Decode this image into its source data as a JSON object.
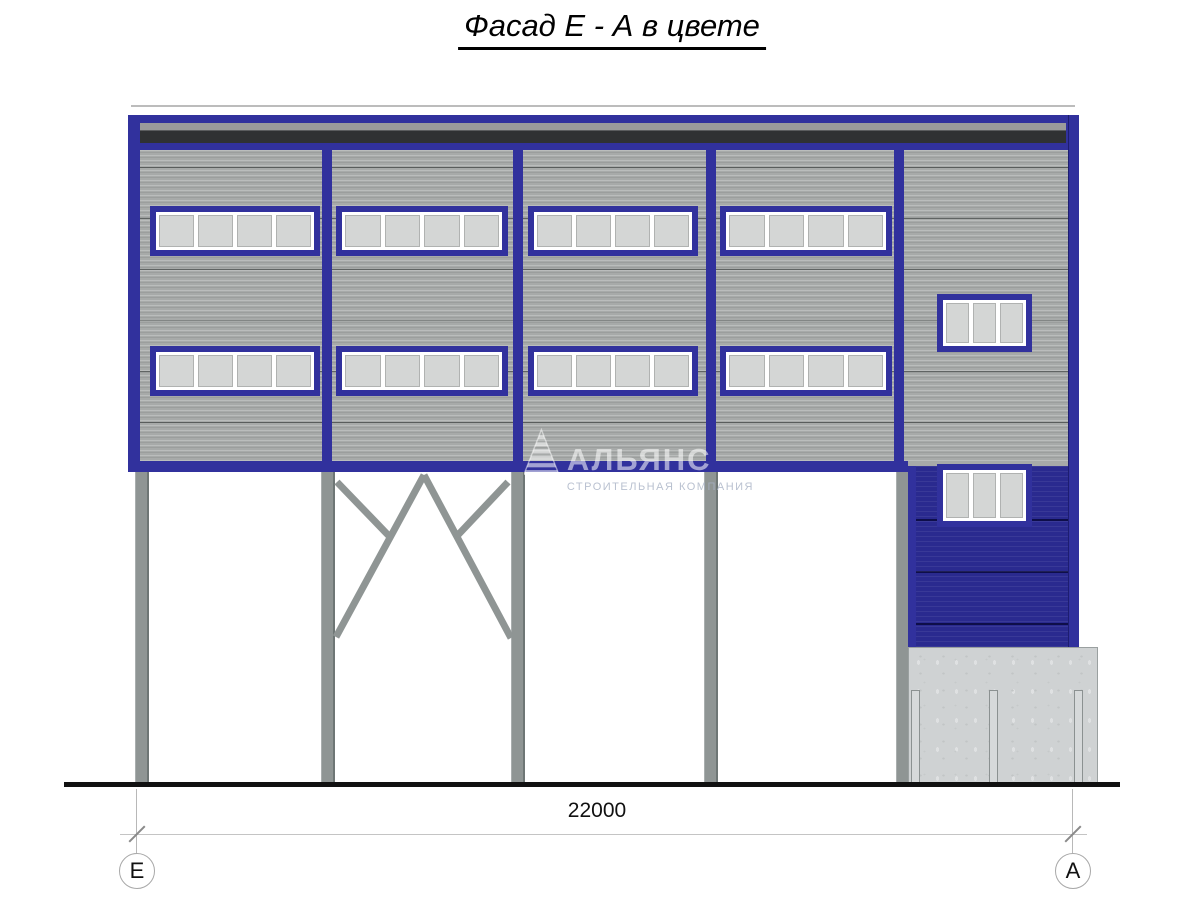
{
  "title": "Фасад Е - А в цвете",
  "dimension": {
    "value": "22000",
    "left_axis": "Е",
    "right_axis": "А"
  },
  "watermark": {
    "name": "АЛЬЯНС",
    "tagline": "СТРОИТЕЛЬНАЯ КОМПАНИЯ"
  },
  "facade": {
    "main_bays": 4,
    "window_rows": 2,
    "main_window_panes": 4,
    "small_window_panes": 3,
    "columns": 5
  },
  "colors": {
    "frame-blue": "#31319d",
    "wall-blue": "#2a2a8f",
    "siding": "#a7aaa9",
    "parapet-gray": "#9b9b9b",
    "parapet-dark": "#2f3133",
    "pane": "#d4d6d5",
    "pane-border": "#b0b2b1",
    "column": "#8f9594",
    "column-edge": "#6e7675",
    "concrete": "#cfd2d3",
    "concrete-edge": "#9aa0a0",
    "ground": "#111111",
    "dim-line": "#c4c4c4",
    "dim-tick": "#8a8a8a",
    "circle-border": "#a8a8a8",
    "ink": "#111111"
  }
}
